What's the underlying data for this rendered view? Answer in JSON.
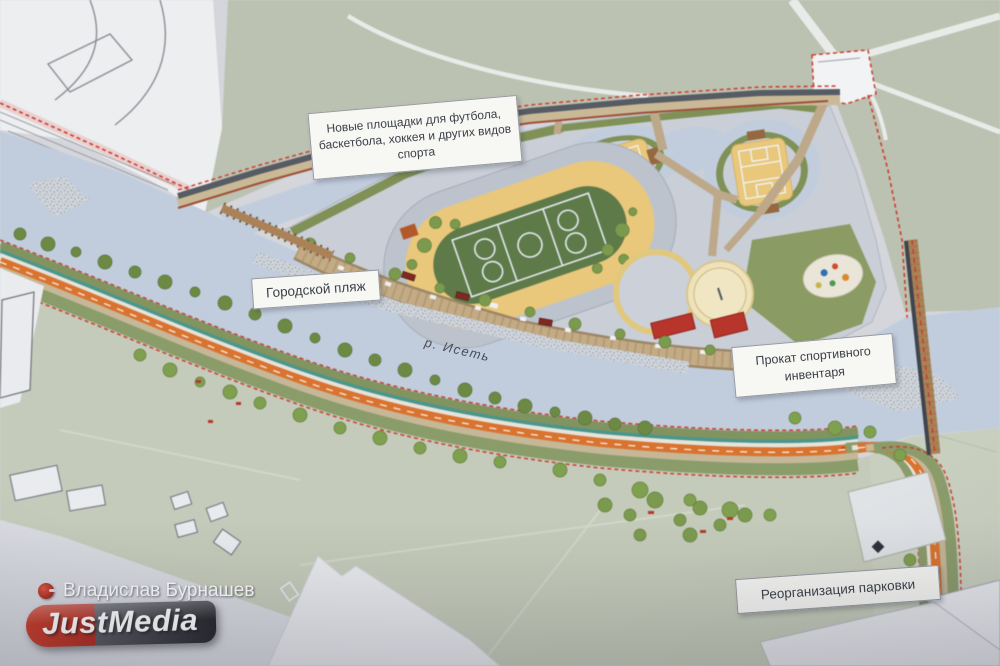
{
  "labels": {
    "new_sports_areas": "Новые площадки для футбола, баскетбола, хоккея и других видов спорта",
    "city_beach": "Городской пляж",
    "river_name": "р. Исеть",
    "sports_rental": "Прокат спортивного инвентаря",
    "parking_reorg": "Реорганизация парковки"
  },
  "watermark": {
    "author": "Владислав Бурнашев",
    "logo_left": "Just",
    "logo_right": "Media"
  },
  "colors": {
    "river": "#c1cddd",
    "grass_top": "#bcc2b1",
    "grass_bottom": "#c5cbba",
    "park_plaza": "#c9ced7",
    "track_yellow": "#e9c77b",
    "field_green": "#5e7a49",
    "bike_path_orange": "#d9732f",
    "boundary_red": "#cc3b2f",
    "logo_red": "#c5372b"
  }
}
